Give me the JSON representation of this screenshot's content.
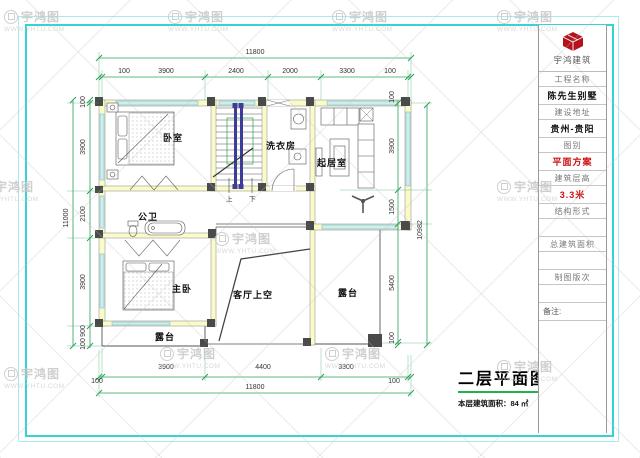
{
  "watermark": {
    "brand": "宇鸿图",
    "url": "WWW.YHTU.COM"
  },
  "title_block": {
    "company": "宇鸿建筑",
    "rows": [
      {
        "label": "工程名称",
        "value": "陈先生别墅"
      },
      {
        "label": "建设地址",
        "value": "贵州-贵阳"
      },
      {
        "label": "图别",
        "value": "平面方案"
      },
      {
        "label": "建筑层高",
        "value": "3.3米"
      },
      {
        "label": "结构形式",
        "value": ""
      },
      {
        "label": "总建筑面积",
        "value": ""
      },
      {
        "label": "制图版次",
        "value": ""
      }
    ],
    "remark_label": "备注:"
  },
  "plan": {
    "rooms": [
      "卧室",
      "洗衣房",
      "起居室",
      "公卫",
      "主卧",
      "客厅上空",
      "露台",
      "露台"
    ],
    "stairs": {
      "up": "上",
      "down": "下"
    },
    "dims": {
      "top": {
        "overall": "11800",
        "chain": [
          "100",
          "3900",
          "2400",
          "2000",
          "3300",
          "100"
        ]
      },
      "bottom": {
        "overall": "11800",
        "chain": [
          "100",
          "3900",
          "4400",
          "3300",
          "100"
        ]
      },
      "left": {
        "overall": "11000",
        "chain": [
          "100",
          "3900",
          "2100",
          "3900",
          "900",
          "100"
        ]
      },
      "right": {
        "overall": "10982",
        "chain": [
          "100",
          "3900",
          "1500",
          "5400",
          "100"
        ]
      }
    }
  },
  "caption": {
    "title": "二层平面图",
    "area": "本层建筑面积：84 ㎡"
  },
  "colors": {
    "frame_cyan": "#35d4d4",
    "dimension_green": "#2ca05a",
    "wall_yellow": "#fbfbc8",
    "window_cyan": "#cdeef0",
    "accent_red": "#cc1111",
    "underline_green": "#22b14c"
  }
}
